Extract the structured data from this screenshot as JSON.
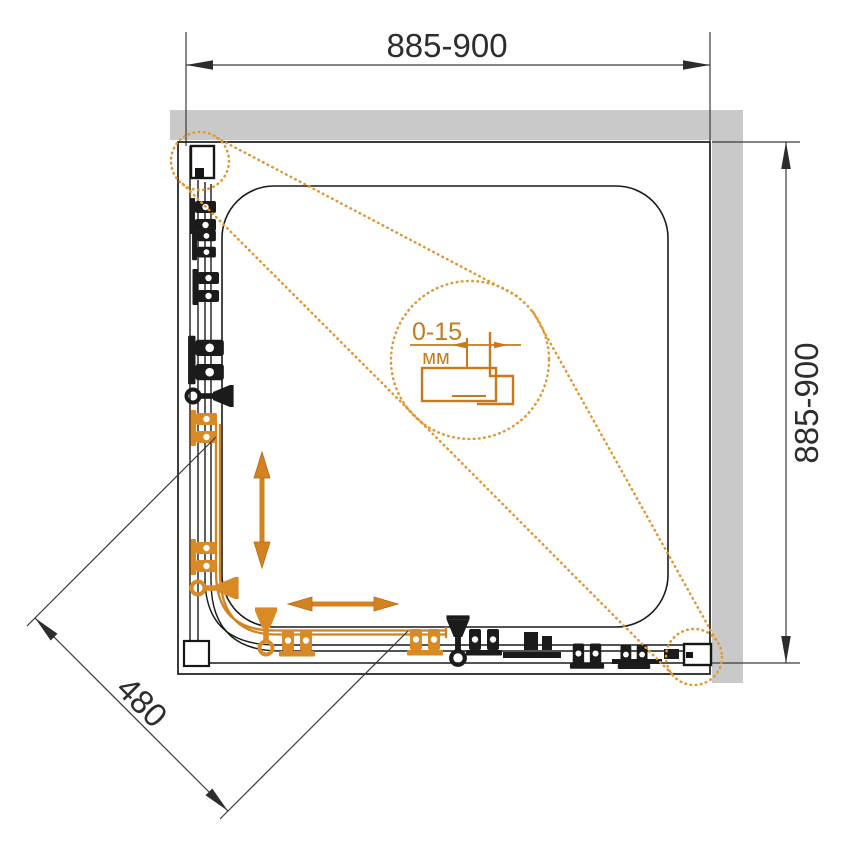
{
  "diagram": {
    "kind": "shower-enclosure-plan-drawing",
    "dimensions": {
      "width_label": "885-900",
      "height_label": "885-900",
      "diagonal_label": "480",
      "detail_range": "0-15",
      "detail_unit": "мм"
    },
    "colors": {
      "accent_orange": "#D4821F",
      "hardware_orange": "#E8A23C",
      "wall_gray": "#C9C9C9",
      "line_black": "#1A1A1A"
    }
  }
}
